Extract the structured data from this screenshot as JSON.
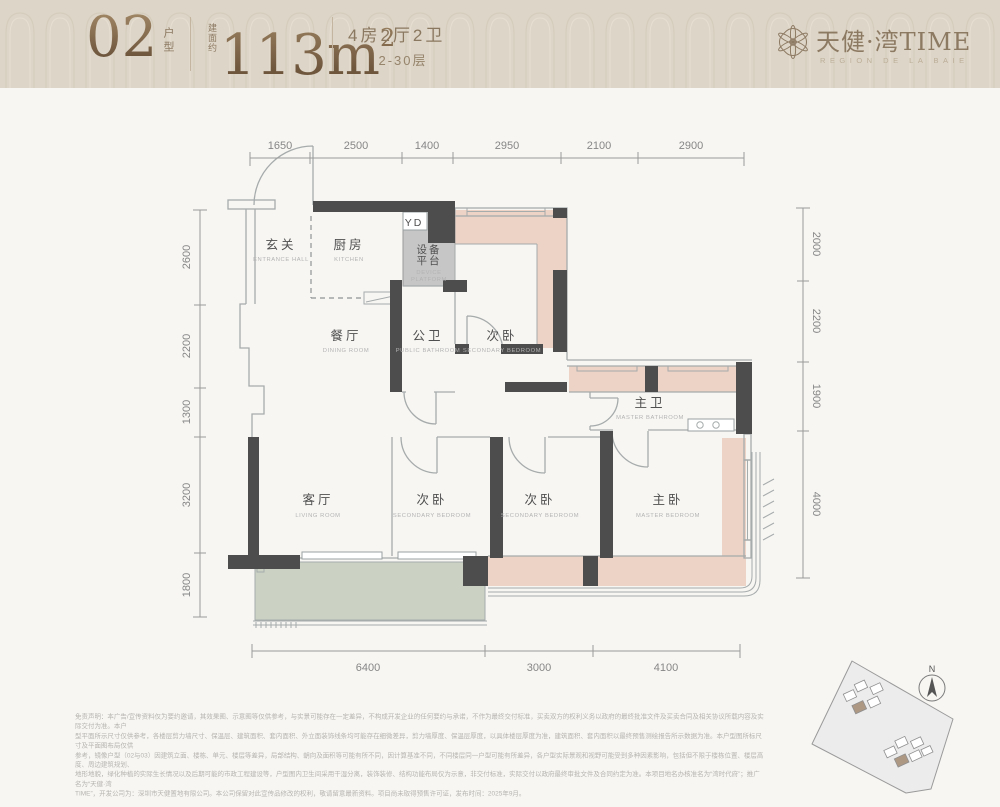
{
  "header": {
    "unit_number": "02",
    "unit_label": "户型",
    "area_prefix": "建面约",
    "area_value": "113m",
    "area_sup": "2",
    "spec": "4房2厅2卫",
    "floors": "2-30层"
  },
  "brand": {
    "name_cn": "天健·湾TIME",
    "name_en": "REGION DE LA BAIE"
  },
  "plan": {
    "flue_label": "YD",
    "rooms": [
      {
        "cn": "玄关",
        "en": "ENTRANCE HALL"
      },
      {
        "cn": "厨房",
        "en": "KITCHEN"
      },
      {
        "cn_line1": "设备",
        "cn_line2": "平台",
        "en_line1": "DEVICE",
        "en_line2": "PLATFORM"
      },
      {
        "cn": "餐厅",
        "en": "DINING ROOM"
      },
      {
        "cn": "公卫",
        "en": "PUBLIC BATHROOM"
      },
      {
        "cn": "次卧",
        "en": "SECONDARY BEDROOM"
      },
      {
        "cn": "主卫",
        "en": "MASTER BATHROOM"
      },
      {
        "cn": "客厅",
        "en": "LIVING ROOM"
      },
      {
        "cn": "次卧",
        "en": "SECONDARY BEDROOM"
      },
      {
        "cn": "次卧",
        "en": "SECONDARY BEDROOM"
      },
      {
        "cn": "主卧",
        "en": "MASTER BEDROOM"
      }
    ],
    "dimensions": {
      "top": [
        "1650",
        "2500",
        "1400",
        "2950",
        "2100",
        "2900"
      ],
      "left": [
        "2600",
        "2200",
        "1300",
        "3200",
        "1800"
      ],
      "right": [
        "2000",
        "2200",
        "1900",
        "4000"
      ],
      "bottom": [
        "6400",
        "3000",
        "4100"
      ]
    }
  },
  "compass": {
    "label": "N"
  },
  "disclaimer": {
    "lines": [
      "免责声明：本广告/宣传资料仅为要约邀请，其效果图、示意图等仅供参考，与实景可能存在一定差异，不构成开发企业的任何要约与承诺，不作为最终交付标准，买卖双方的权利义务以政府的最终批准文件及买卖合同及相关协议所载内容及实际交付为准。本户",
      "型平面所示尺寸仅供参考，各楼层剪力墙尺寸、保温层、建筑面积、套内面积、外立面装饰线条均可能存在细微差异，剪力墙厚度、保温层厚度，以具体楼层厚度为准，建筑面积、套内面积以最终预售测绘报告所示数据为准。本户型图所标尺寸及平面图布局仅供",
      "参考，镜像户型（02与03）因建筑立面、楼栋、单元、楼层等差异，局部结构、朝向及面积等可能有所不同，因计算基准不同，不同楼层同一户型可能有所差异，各户型实际景观和视野可能受到多种因素影响，包括但不限于楼栋位置、楼层高度、周边建筑规划、",
      "地形地貌，绿化种植的实际生长情况以及后期可能的市政工程建设等，户型图内卫生间采用干湿分离，装饰装修、结构功能布局仅为示意，非交付标准，实际交付以政府最终审批文件及合同约定为准。本项目地名办核准名为“湾时代府”；推广名为“天健·湾",
      "TIME”，开发公司为：深圳市天健置地有限公司。本公司保留对此宣传品修改的权利，敬请留意最新资料。项目尚未取得预售许可证，发布时间：2025年9月。"
    ]
  },
  "colors": {
    "header_bg": "#ddd5c7",
    "accent_bronze": "#8a7158",
    "wall_dark": "#4d4d4d",
    "bedroom_pink": "#ecd3c5",
    "balcony_green": "#cbd2c4",
    "platform_gray": "#c6c6c6",
    "page_bg": "#f7f6f3"
  }
}
